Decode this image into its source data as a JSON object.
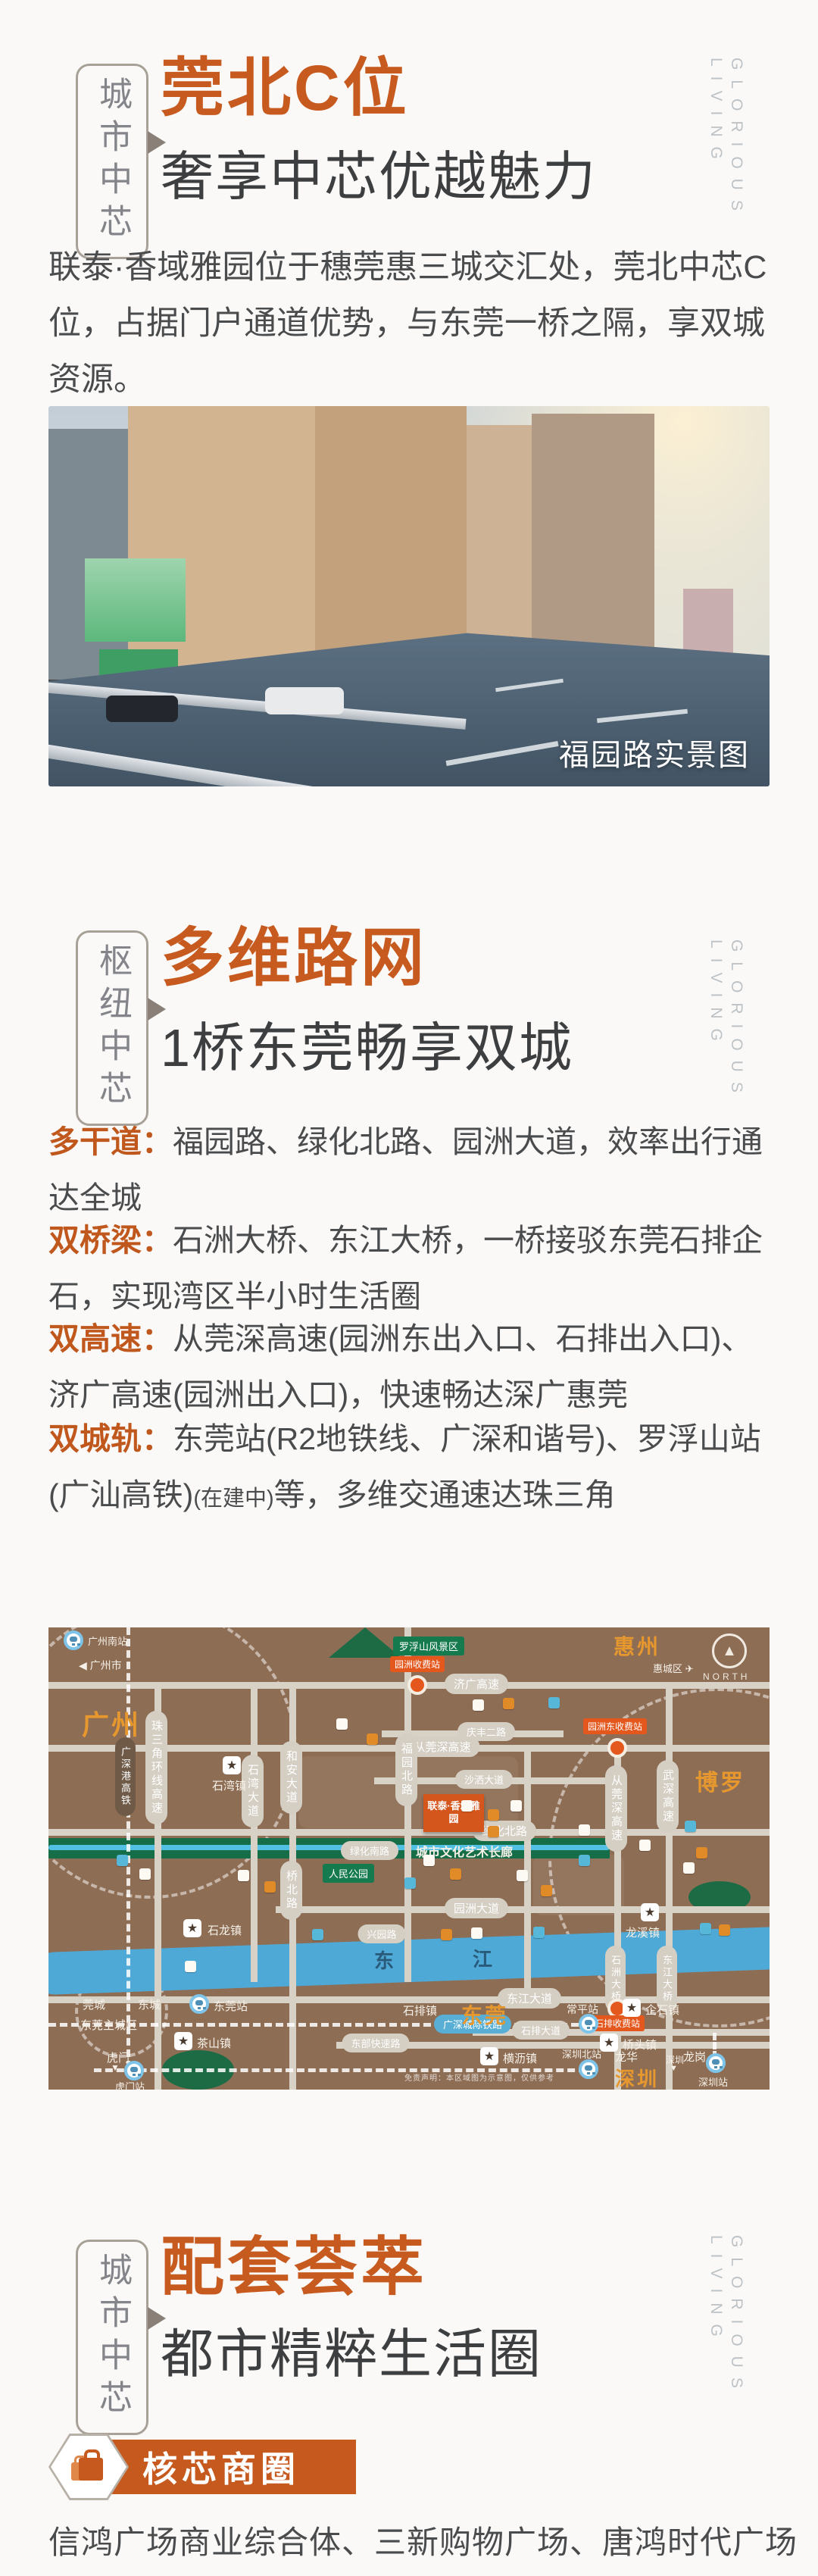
{
  "icons": {
    "left_arrow": "◀",
    "down_arrow": "▼",
    "star": "★",
    "north_arrow": "▲",
    "plane": "✈"
  },
  "watermark": {
    "word1": "GLORIOUS",
    "word2": "LIVING"
  },
  "sections": {
    "location": {
      "tag": "城市中芯",
      "title": "莞北C位",
      "subtitle": "奢享中芯优越魅力",
      "paragraph": "联泰·香域雅园位于穗莞惠三城交汇处，莞北中芯C位，占据门户通道优势，与东莞一桥之隔，享双城资源。",
      "photo_caption": "福园路实景图"
    },
    "transport": {
      "tag": "枢纽中芯",
      "title": "多维路网",
      "subtitle": "1桥东莞畅享双城",
      "bullets": [
        {
          "label": "多干道：",
          "text": "福园路、绿化北路、园洲大道，效率出行通达全城"
        },
        {
          "label": "双桥梁：",
          "text": "石洲大桥、东江大桥，一桥接驳东莞石排企石，实现湾区半小时生活圈"
        },
        {
          "label": "双高速：",
          "text": "从莞深高速(园洲东出入口、石排出入口)、济广高速(园洲出入口)，快速畅达深广惠莞"
        },
        {
          "label": "双城轨：",
          "t1": "东莞站(R2地铁线、广深和谐号)、罗浮山站(广汕高铁)",
          "small": "(在建中)",
          "t2": "等，多维交通速达珠三角"
        }
      ]
    },
    "amenity": {
      "tag": "城市中芯",
      "title": "配套荟萃",
      "subtitle": "都市精粹生活圈",
      "badge_label": "核芯商圈",
      "shops": "信鸿广场商业综合体、三新购物广场、唐鸿时代广场"
    }
  },
  "map": {
    "regions": {
      "guangzhou": "广州",
      "huizhou": "惠州",
      "boluo": "博罗",
      "dongguan": "东莞",
      "shenzhen": "深圳"
    },
    "areas": {
      "huicheng": "惠城区",
      "guancheng": "莞城",
      "dongcheng": "东城",
      "dongguan_main": "东莞主城区",
      "longhua": "龙华",
      "longgang": "龙岗",
      "humen": "虎门",
      "shenzhen_small": "深圳"
    },
    "compass_label": "NORTH",
    "scenic_area": "罗浮山风景区",
    "guangzhou_city": "广州市",
    "corridor_label": "城市文化艺术长廊",
    "peoples_park": "人民公园",
    "project_name": "联泰·香域雅园",
    "river_char_1": "东",
    "river_char_2": "江",
    "roads_h": {
      "jiguang": "济广高速",
      "congguanshen": "从莞深高速",
      "qingfeng": "庆丰二路",
      "shasa": "沙洒大道",
      "lvhua_north": "绿化北路",
      "lvhua_south": "绿化南路",
      "xingyuan": "兴园路",
      "yuanzhou": "园洲大道",
      "dongjiang": "东江大道",
      "shipai": "石排大道",
      "dongbu": "东部快速路"
    },
    "roads_v": {
      "zhusanjiao": "珠三角环线高速",
      "shiwan": "石湾大道",
      "hean": "和安大道",
      "qiaobei": "桥北路",
      "fuyuan_north": "福园北路",
      "congguanshen": "从莞深高速",
      "wushen": "武深高速",
      "shizhou_bridge": "石洲大桥",
      "dongjiang_bridge": "东江大桥"
    },
    "rails": {
      "gangshen": "广深港高铁",
      "chengji": "广深城际铁路"
    },
    "stations": {
      "guangzhou_south": "广州南站",
      "dongguan": "东莞站",
      "humen": "虎门站",
      "changping": "常平站",
      "shenzhen_north": "深圳北站",
      "shenzhen": "深圳站"
    },
    "towns": {
      "shiwan": "石湾镇",
      "shilong": "石龙镇",
      "chashan": "茶山镇",
      "shipai": "石排镇",
      "qishi": "企石镇",
      "qiaotou": "桥头镇",
      "hengli": "横沥镇",
      "longxi": "龙溪镇"
    },
    "tolls": {
      "yuanzhou": "园洲收费站",
      "yuanzhou_east": "园洲东收费站",
      "shipai": "石排收费站"
    },
    "disclaimer": "免责声明：本区域图为示意图，仅供参考",
    "pois": [
      [
        560,
        95,
        "w"
      ],
      [
        600,
        93,
        "o"
      ],
      [
        660,
        92,
        "b"
      ],
      [
        545,
        228,
        "w"
      ],
      [
        580,
        240,
        "o"
      ],
      [
        610,
        228,
        "w"
      ],
      [
        580,
        262,
        "o"
      ],
      [
        495,
        300,
        "w"
      ],
      [
        530,
        318,
        "o"
      ],
      [
        470,
        330,
        "b"
      ],
      [
        618,
        320,
        "w"
      ],
      [
        650,
        340,
        "o"
      ],
      [
        700,
        260,
        "w"
      ],
      [
        700,
        300,
        "b"
      ],
      [
        780,
        280,
        "w"
      ],
      [
        840,
        255,
        "b"
      ],
      [
        855,
        290,
        "o"
      ],
      [
        838,
        310,
        "w"
      ],
      [
        860,
        390,
        "b"
      ],
      [
        885,
        392,
        "o"
      ],
      [
        90,
        300,
        "b"
      ],
      [
        120,
        318,
        "w"
      ],
      [
        250,
        320,
        "w"
      ],
      [
        285,
        335,
        "o"
      ],
      [
        380,
        120,
        "w"
      ],
      [
        420,
        140,
        "o"
      ],
      [
        180,
        440,
        "w"
      ],
      [
        518,
        398,
        "o"
      ],
      [
        558,
        396,
        "w"
      ],
      [
        348,
        398,
        "b"
      ],
      [
        640,
        395,
        "b"
      ]
    ]
  },
  "colors": {
    "accent": "#c75a1f",
    "heading": "#3d3e40",
    "body": "#4a4b4d",
    "map_bg": "#8e6d55",
    "river": "#4fa9d6",
    "map_orange": "#e6982f",
    "toll": "#e4571d",
    "park": "#1d6b45"
  }
}
